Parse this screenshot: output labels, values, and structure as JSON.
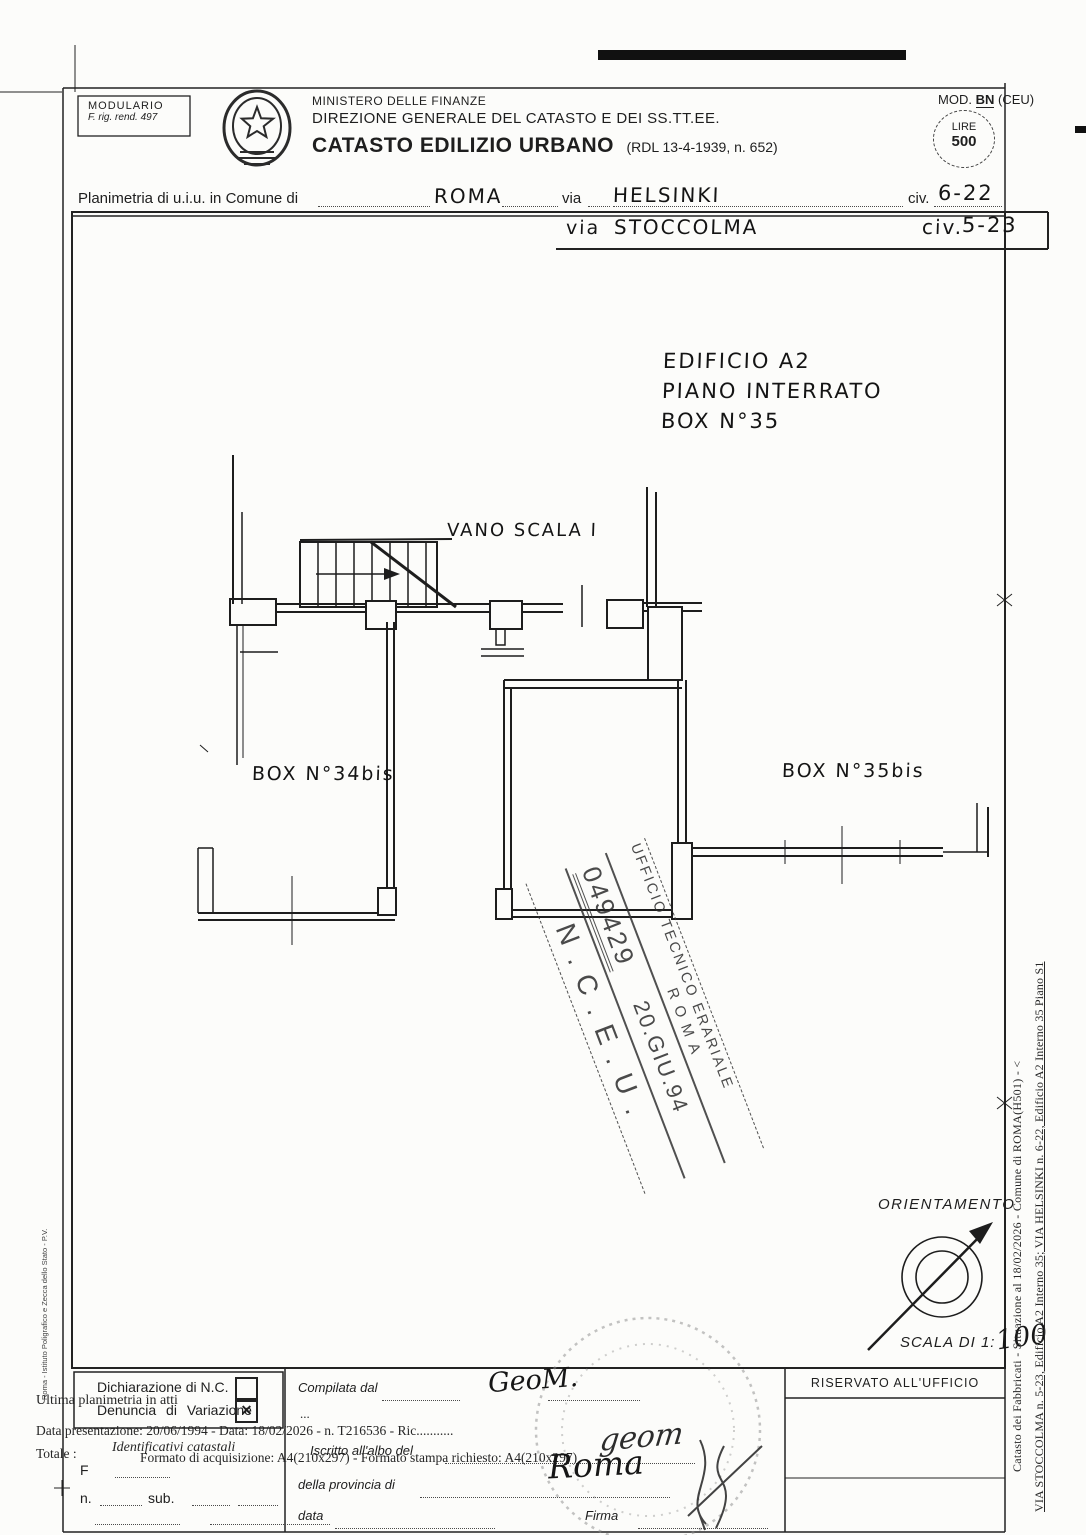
{
  "header": {
    "modulario": {
      "line1": "MODULARIO",
      "line2": "F. rig. rend. 497"
    },
    "ministry_small": "MINISTERO DELLE FINANZE",
    "ministry_division": "DIREZIONE GENERALE DEL CATASTO E DEI SS.TT.EE.",
    "title": "CATASTO EDILIZIO URBANO",
    "title_ref": "(RDL 13-4-1939, n. 652)",
    "mod": {
      "prefix": "MOD.",
      "code": "BN",
      "suffix": "(CEU)"
    },
    "stamp_fee": {
      "line1": "LIRE",
      "line2": "500"
    }
  },
  "address": {
    "row1": {
      "label": "Planimetria di u.i.u. in Comune di",
      "comune": "ROMA",
      "via_label": "via",
      "via": "HELSINKI",
      "civ_label": "civ.",
      "civ": "6-22"
    },
    "row2": {
      "via_label": "via",
      "via": "STOCCOLMA",
      "civ_label": "civ.",
      "civ": "5-23"
    }
  },
  "plan": {
    "annotation": [
      "EDIFICIO A2",
      "PIANO INTERRATO",
      "BOX N°35"
    ],
    "labels": {
      "stairwell": "VANO SCALA I",
      "box34": "BOX N°34bis",
      "box35bis": "BOX N°35bis"
    }
  },
  "office_stamp": {
    "office_line": "UFFICIO TECNICO ERARIALE",
    "city": "ROMA",
    "number": "049429",
    "date": "20.GIU.94",
    "registry": "N.C.E.U."
  },
  "orientation": {
    "title": "ORIENTAMENTO",
    "scale_label": "SCALA DI 1:",
    "scale_value": "100"
  },
  "footer": {
    "declarations": {
      "nc_label": "Dichiarazione di N.C.",
      "nc_mark": "",
      "var_label": "Denuncia di Variazione",
      "var_mark": "✕"
    },
    "overlays": {
      "ultima": "Ultima planimetria in atti",
      "data_line": "Data presentazione: 20/06/1994 - Data: 18/02/2026 - n. T216536 - Ric...........",
      "totale": "Totale :",
      "formato": "Formato di acquisizione: A4(210x297)  -  Formato stampa richiesto: A4(210x297)"
    },
    "catastali": {
      "title": "Identificativi catastali",
      "f": "F",
      "n": "n.",
      "sub": "sub."
    },
    "compiler": {
      "compilata": "Compilata dal",
      "compilata_value": "GeoM.",
      "dots3": "...",
      "iscritto": "Iscritto all'albo del",
      "iscritto_value": "geom",
      "provincia": "della provincia di",
      "provincia_value": "Roma",
      "data_label": "data",
      "firma_label": "Firma"
    },
    "office_box": {
      "title": "RISERVATO ALL'UFFICIO"
    }
  },
  "margins": {
    "left_vertical": "Roma - Istituto Poligrafico e Zecca dello Stato - P.V.",
    "right_vertical_line1": "Catasto dei Fabbricati - Situazione al 18/02/2026 - Comune di ROMA(H501) - <",
    "right_vertical_line2": "VIA STOCCOLMA n. 5-23, Edificio A2 Interno 35; VIA HELSINKI n. 6-22, Edificio A2 Interno 35 Piano S1"
  }
}
